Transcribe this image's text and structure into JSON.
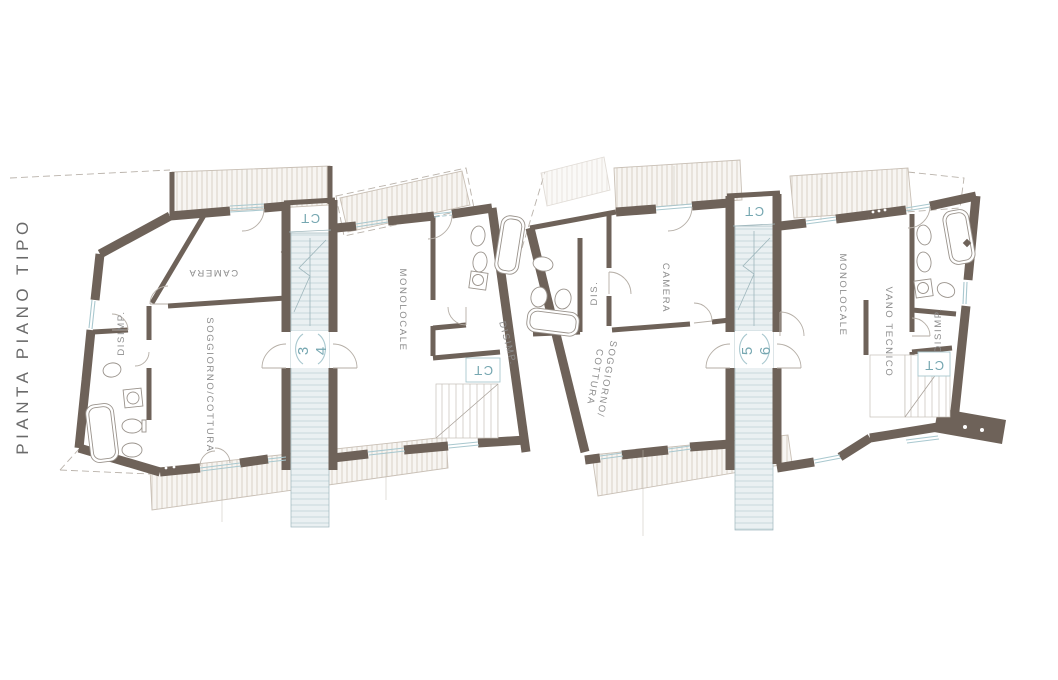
{
  "title": "PIANTA PIANO TIPO",
  "units": {
    "unit1": {
      "camera": "CAMERA",
      "disimp": "DISIMP.",
      "soggiorno_cottura": "SOGGIORNO/COTTURA"
    },
    "unit2": {
      "monolocale": "MONOLOCALE",
      "disimp": "DISIMP.",
      "ct": "CT"
    },
    "unit3": {
      "dis": "DIS.",
      "camera": "CAMERA",
      "soggiorno": "SOGGIORNO/",
      "cottura": "COTTURA"
    },
    "unit4": {
      "monolocale": "MONOLOCALE",
      "vano_tecnico": "VANO TECNICO",
      "disimp": "DISIMP.",
      "ct": "CT"
    }
  },
  "stairwells": {
    "a": {
      "ct": "CT",
      "apartment_numbers": [
        "3",
        "4"
      ]
    },
    "b": {
      "ct": "CT",
      "apartment_numbers": [
        "5",
        "6"
      ]
    }
  },
  "colors": {
    "wall": "#6e6259",
    "accent_teal": "#76a7b1",
    "label_gray": "#8d8d8d",
    "stair_fill": "#eaf0f2",
    "stair_line": "#bdd0d5",
    "hatch_line": "#d6cdc2",
    "title_gray": "#6a6a6a"
  }
}
